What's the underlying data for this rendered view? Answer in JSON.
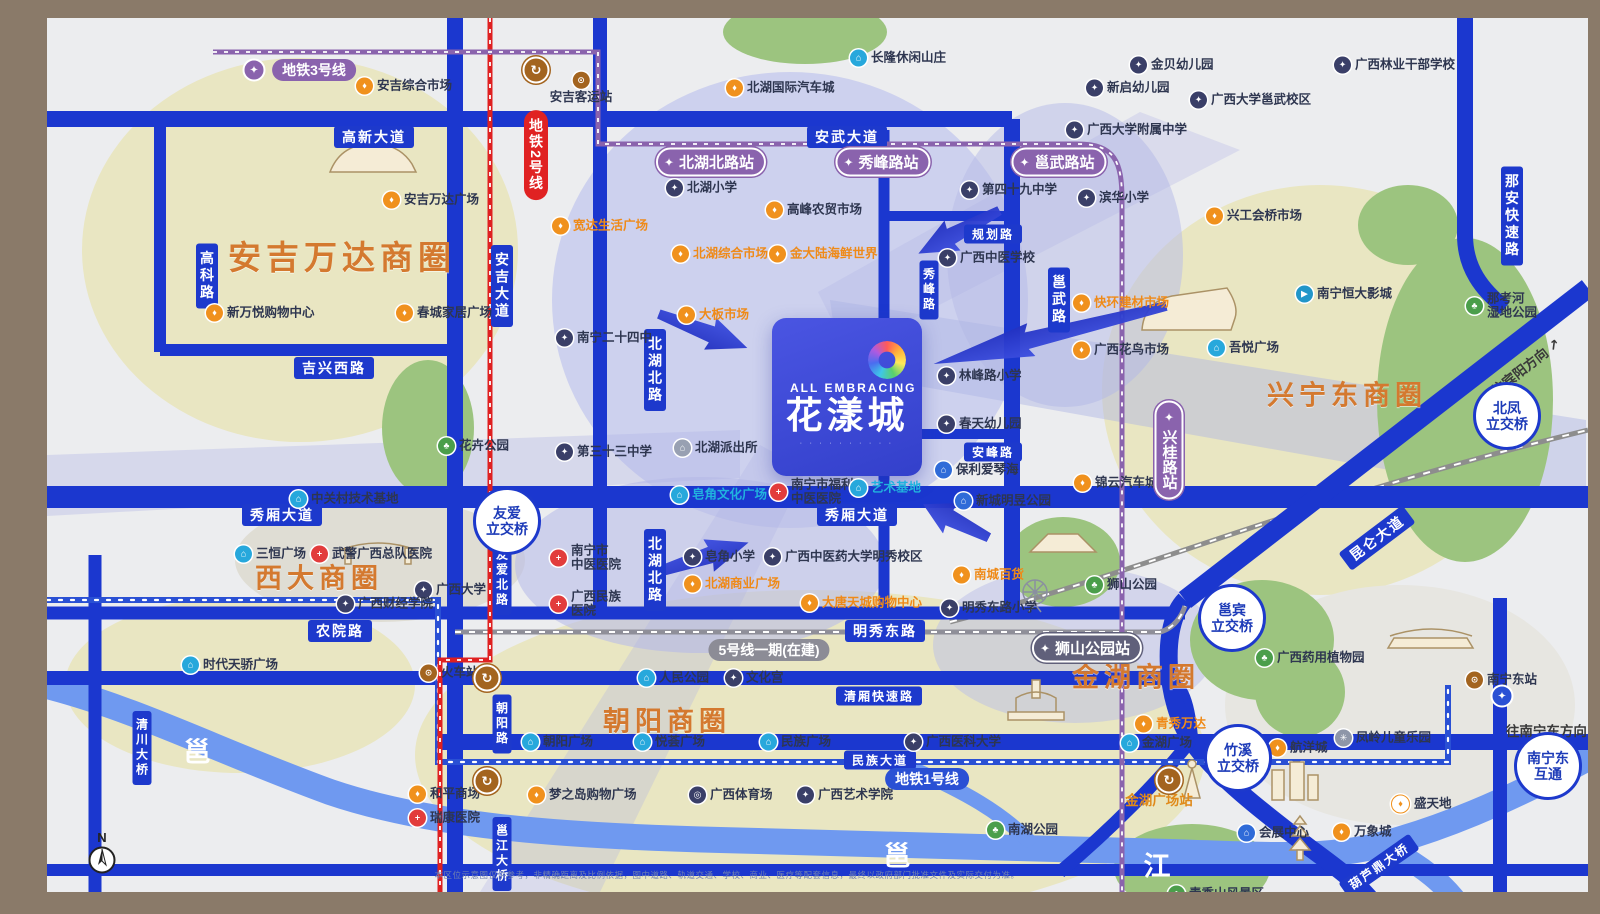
{
  "logo": {
    "en": "ALL EMBRACING",
    "name": "花漾城",
    "tagline": "∙ ∙ ∙ ∙ ∙ ∙ ∙ ∙ ∙ ∙"
  },
  "compass_label": "N",
  "disclaimer": "本区位示意图仅供参考，非精确距离及比例依据，图中道路、轨道交通、学校、商业、医疗等配套信息，最终以政府部门批准文件及实际交付为准。",
  "zone_titles": [
    {
      "label": "安吉万达商圈",
      "x": 295,
      "y": 237,
      "size": 33
    },
    {
      "label": "西大商圈",
      "x": 272,
      "y": 558,
      "size": 27
    },
    {
      "label": "兴宁东商圈",
      "x": 1300,
      "y": 375,
      "size": 27
    },
    {
      "label": "朝阳商圈",
      "x": 620,
      "y": 701,
      "size": 27
    },
    {
      "label": "金湖商圈",
      "x": 1089,
      "y": 657,
      "size": 27
    }
  ],
  "road_labels": [
    {
      "label": "高新大道",
      "x": 327,
      "y": 119
    },
    {
      "label": "安武大道",
      "x": 800,
      "y": 119
    },
    {
      "label": "吉兴西路",
      "x": 287,
      "y": 350
    },
    {
      "label": "规划路",
      "x": 946,
      "y": 216,
      "size": 12
    },
    {
      "label": "安峰路",
      "x": 946,
      "y": 434,
      "size": 12
    },
    {
      "label": "秀峰路",
      "x": 882,
      "y": 272,
      "mode": "v",
      "size": 12
    },
    {
      "label": "邕武路",
      "x": 1012,
      "y": 282,
      "mode": "v"
    },
    {
      "label": "秀厢大道",
      "x": 235,
      "y": 497
    },
    {
      "label": "秀厢大道",
      "x": 810,
      "y": 497
    },
    {
      "label": "农院路",
      "x": 293,
      "y": 613
    },
    {
      "label": "明秀东路",
      "x": 838,
      "y": 613
    },
    {
      "label": "清厢快速路",
      "x": 832,
      "y": 678,
      "size": 12
    },
    {
      "label": "民族大道",
      "x": 833,
      "y": 742,
      "size": 12
    },
    {
      "label": "北湖北路",
      "x": 608,
      "y": 352,
      "mode": "v"
    },
    {
      "label": "北湖北路",
      "x": 608,
      "y": 552,
      "mode": "v"
    },
    {
      "label": "高科路",
      "x": 160,
      "y": 258,
      "mode": "v"
    },
    {
      "label": "安吉大道",
      "x": 455,
      "y": 268,
      "mode": "v"
    },
    {
      "label": "友爱北路",
      "x": 455,
      "y": 560,
      "mode": "v",
      "size": 12
    },
    {
      "label": "朝阳路",
      "x": 455,
      "y": 706,
      "mode": "v",
      "size": 12
    },
    {
      "label": "那安快速路",
      "x": 1465,
      "y": 198,
      "mode": "v"
    },
    {
      "label": "清川大桥",
      "x": 95,
      "y": 730,
      "mode": "v",
      "size": 12
    },
    {
      "label": "邕江大桥",
      "x": 455,
      "y": 836,
      "mode": "v",
      "size": 12
    },
    {
      "label": "昆仑大道",
      "x": 1330,
      "y": 520,
      "rot": -37
    },
    {
      "label": "葫芦鼎大桥",
      "x": 1332,
      "y": 848,
      "rot": -35,
      "size": 12
    }
  ],
  "stations": [
    {
      "label": "北湖北路站",
      "x": 664,
      "y": 144
    },
    {
      "label": "秀峰路站",
      "x": 836,
      "y": 144
    },
    {
      "label": "邕武路站",
      "x": 1012,
      "y": 144
    },
    {
      "label": "兴桂路站",
      "x": 1122,
      "y": 432,
      "mode": "v"
    },
    {
      "label": "狮山公园站",
      "x": 1040,
      "y": 630,
      "color": "slate"
    }
  ],
  "line_pills": [
    {
      "label": "地铁3号线",
      "x": 267,
      "y": 52,
      "color": "purple"
    },
    {
      "label": "地铁2号线",
      "x": 489,
      "y": 137,
      "color": "red",
      "mode": "v"
    },
    {
      "label": "地铁1号线",
      "x": 880,
      "y": 761,
      "color": "blue"
    },
    {
      "label": "5号线一期(在建)",
      "x": 722,
      "y": 632,
      "color": "gray"
    }
  ],
  "transfers": [
    {
      "x": 489,
      "y": 52
    },
    {
      "x": 440,
      "y": 660
    },
    {
      "x": 440,
      "y": 763
    },
    {
      "x": 1122,
      "y": 762
    }
  ],
  "metro_marks": [
    {
      "x": 207,
      "y": 52,
      "color": "#8a63ad"
    },
    {
      "x": 1455,
      "y": 678,
      "color": "#2a50d4"
    }
  ],
  "interchanges": [
    {
      "label": "友爱|立交桥",
      "x": 460,
      "y": 503
    },
    {
      "label": "北凤|立交桥",
      "x": 1460,
      "y": 398
    },
    {
      "label": "邕宾|立交桥",
      "x": 1185,
      "y": 600
    },
    {
      "label": "竹溪|立交桥",
      "x": 1191,
      "y": 740
    },
    {
      "label": "南宁东|互通",
      "x": 1501,
      "y": 748
    }
  ],
  "directions": [
    {
      "label": "往宾阳方向 ↗",
      "x": 1478,
      "y": 348,
      "rot": -38
    },
    {
      "label": "往南宁东方向 →",
      "x": 1508,
      "y": 712,
      "rot": 0
    }
  ],
  "river_labels": [
    {
      "label": "邕",
      "x": 150,
      "y": 732
    },
    {
      "label": "邕",
      "x": 850,
      "y": 836
    },
    {
      "label": "江",
      "x": 1110,
      "y": 846
    }
  ],
  "station_text": [
    {
      "label": "金湖广场站",
      "x": 1112,
      "y": 781
    }
  ],
  "pois": [
    {
      "label": "安吉综合市场",
      "x": 318,
      "y": 68,
      "type": "market"
    },
    {
      "label": "安吉客运站",
      "x": 534,
      "y": 70,
      "type": "train",
      "labelpos": "below"
    },
    {
      "label": "北湖国际汽车城",
      "x": 688,
      "y": 70,
      "type": "market"
    },
    {
      "label": "长隆休闲山庄",
      "x": 812,
      "y": 40,
      "type": "museum"
    },
    {
      "label": "金贝幼儿园",
      "x": 1092,
      "y": 47,
      "type": "school"
    },
    {
      "label": "新启幼儿园",
      "x": 1048,
      "y": 70,
      "type": "school"
    },
    {
      "label": "广西大学邕武校区",
      "x": 1152,
      "y": 82,
      "type": "school"
    },
    {
      "label": "广西林业干部学校",
      "x": 1296,
      "y": 47,
      "type": "school"
    },
    {
      "label": "广西大学附属中学",
      "x": 1028,
      "y": 112,
      "type": "school"
    },
    {
      "label": "滨华小学",
      "x": 1040,
      "y": 180,
      "type": "school"
    },
    {
      "label": "兴工会桥市场",
      "x": 1168,
      "y": 198,
      "type": "market"
    },
    {
      "label": "北湖小学",
      "x": 628,
      "y": 170,
      "type": "school"
    },
    {
      "label": "高峰农贸市场",
      "x": 728,
      "y": 192,
      "type": "market"
    },
    {
      "label": "第四十九中学",
      "x": 923,
      "y": 172,
      "type": "school"
    },
    {
      "label": "宽达生活广场",
      "x": 514,
      "y": 208,
      "type": "market",
      "style": "accent"
    },
    {
      "label": "北湖综合市场",
      "x": 634,
      "y": 236,
      "type": "market",
      "style": "accent"
    },
    {
      "label": "金大陆海鲜世界",
      "x": 731,
      "y": 236,
      "type": "market",
      "style": "accent"
    },
    {
      "label": "广西中医学校",
      "x": 901,
      "y": 240,
      "type": "school"
    },
    {
      "label": "新万悦购物中心",
      "x": 168,
      "y": 295,
      "type": "market"
    },
    {
      "label": "春城家居广场",
      "x": 358,
      "y": 295,
      "type": "market"
    },
    {
      "label": "安吉万达广场",
      "x": 345,
      "y": 182,
      "type": "market"
    },
    {
      "label": "南宁二十四中",
      "x": 518,
      "y": 320,
      "type": "school"
    },
    {
      "label": "大板市场",
      "x": 640,
      "y": 297,
      "type": "market",
      "style": "accent"
    },
    {
      "label": "快环建材市场",
      "x": 1035,
      "y": 285,
      "type": "market",
      "style": "accent"
    },
    {
      "label": "广西花鸟市场",
      "x": 1035,
      "y": 332,
      "type": "market"
    },
    {
      "label": "南宁恒大影城",
      "x": 1258,
      "y": 276,
      "type": "cinema"
    },
    {
      "label": "吾悦广场",
      "x": 1170,
      "y": 330,
      "type": "museum"
    },
    {
      "label": "那考河|湿地公园",
      "x": 1428,
      "y": 288,
      "type": "park"
    },
    {
      "label": "花卉公园",
      "x": 400,
      "y": 428,
      "type": "park"
    },
    {
      "label": "第三十三中学",
      "x": 518,
      "y": 434,
      "type": "school"
    },
    {
      "label": "北湖派出所",
      "x": 636,
      "y": 430,
      "type": "police"
    },
    {
      "label": "林峰路小学",
      "x": 900,
      "y": 358,
      "type": "school"
    },
    {
      "label": "春天幼儿园",
      "x": 900,
      "y": 406,
      "type": "school"
    },
    {
      "label": "保利爱琴海",
      "x": 897,
      "y": 452,
      "type": "building"
    },
    {
      "label": "新城明昱公园",
      "x": 917,
      "y": 483,
      "type": "building"
    },
    {
      "label": "皂角文化广场",
      "x": 633,
      "y": 477,
      "type": "museum",
      "style": "cyan"
    },
    {
      "label": "南宁市福利|中医医院",
      "x": 732,
      "y": 474,
      "type": "hospital"
    },
    {
      "label": "艺术基地",
      "x": 812,
      "y": 470,
      "type": "museum",
      "style": "cyan"
    },
    {
      "label": "中关村技术基地",
      "x": 252,
      "y": 481,
      "type": "museum"
    },
    {
      "label": "三恒广场",
      "x": 197,
      "y": 536,
      "type": "museum"
    },
    {
      "label": "武警广西总队医院",
      "x": 273,
      "y": 536,
      "type": "hospital"
    },
    {
      "label": "广西大学",
      "x": 377,
      "y": 572,
      "type": "school"
    },
    {
      "label": "广西财经学院",
      "x": 299,
      "y": 586,
      "type": "school"
    },
    {
      "label": "南宁市|中医医院",
      "x": 512,
      "y": 540,
      "type": "hospital"
    },
    {
      "label": "广西民族|医院",
      "x": 512,
      "y": 586,
      "type": "hospital"
    },
    {
      "label": "皂角小学",
      "x": 646,
      "y": 539,
      "type": "school"
    },
    {
      "label": "广西中医药大学明秀校区",
      "x": 726,
      "y": 539,
      "type": "school"
    },
    {
      "label": "北湖商业广场",
      "x": 646,
      "y": 566,
      "type": "market",
      "style": "accent"
    },
    {
      "label": "大唐天城购物中心",
      "x": 763,
      "y": 585,
      "type": "market",
      "style": "accent"
    },
    {
      "label": "南城百货",
      "x": 915,
      "y": 557,
      "type": "market",
      "style": "accent"
    },
    {
      "label": "明秀东路小学",
      "x": 903,
      "y": 590,
      "type": "school"
    },
    {
      "label": "时代天骄广场",
      "x": 144,
      "y": 647,
      "type": "museum"
    },
    {
      "label": "火车站",
      "x": 382,
      "y": 655,
      "type": "train"
    },
    {
      "label": "朝阳广场",
      "x": 484,
      "y": 724,
      "type": "museum"
    },
    {
      "label": "和平商场",
      "x": 371,
      "y": 776,
      "type": "market"
    },
    {
      "label": "瑞康医院",
      "x": 371,
      "y": 800,
      "type": "hospital"
    },
    {
      "label": "梦之岛购物广场",
      "x": 490,
      "y": 777,
      "type": "market"
    },
    {
      "label": "广西体育场",
      "x": 651,
      "y": 777,
      "type": "stadium"
    },
    {
      "label": "广西艺术学院",
      "x": 759,
      "y": 777,
      "type": "school"
    },
    {
      "label": "人民公园",
      "x": 600,
      "y": 660,
      "type": "museum"
    },
    {
      "label": "文化宫",
      "x": 687,
      "y": 660,
      "type": "school"
    },
    {
      "label": "悦荟广场",
      "x": 596,
      "y": 724,
      "type": "museum"
    },
    {
      "label": "民族广场",
      "x": 722,
      "y": 724,
      "type": "museum"
    },
    {
      "label": "广西医科大学",
      "x": 867,
      "y": 724,
      "type": "school"
    },
    {
      "label": "青秀万达",
      "x": 1097,
      "y": 706,
      "type": "market",
      "style": "accent"
    },
    {
      "label": "金湖广场",
      "x": 1083,
      "y": 725,
      "type": "museum"
    },
    {
      "label": "航洋城",
      "x": 1231,
      "y": 730,
      "type": "market"
    },
    {
      "label": "凤岭儿童乐园",
      "x": 1297,
      "y": 720,
      "type": "attraction"
    },
    {
      "label": "广西药用植物园",
      "x": 1218,
      "y": 640,
      "type": "park"
    },
    {
      "label": "南湖公园",
      "x": 949,
      "y": 812,
      "type": "park"
    },
    {
      "label": "会展中心",
      "x": 1200,
      "y": 815,
      "type": "building"
    },
    {
      "label": "万象城",
      "x": 1295,
      "y": 814,
      "type": "market"
    },
    {
      "label": "盛天地",
      "x": 1353,
      "y": 786,
      "type": "market_o"
    },
    {
      "label": "南宁东站",
      "x": 1428,
      "y": 662,
      "type": "train"
    },
    {
      "label": "锦云汽车城",
      "x": 1036,
      "y": 465,
      "type": "market"
    },
    {
      "label": "狮山公园",
      "x": 1048,
      "y": 567,
      "type": "park"
    },
    {
      "label": "青秀山风景区",
      "x": 1130,
      "y": 876,
      "type": "park"
    }
  ]
}
